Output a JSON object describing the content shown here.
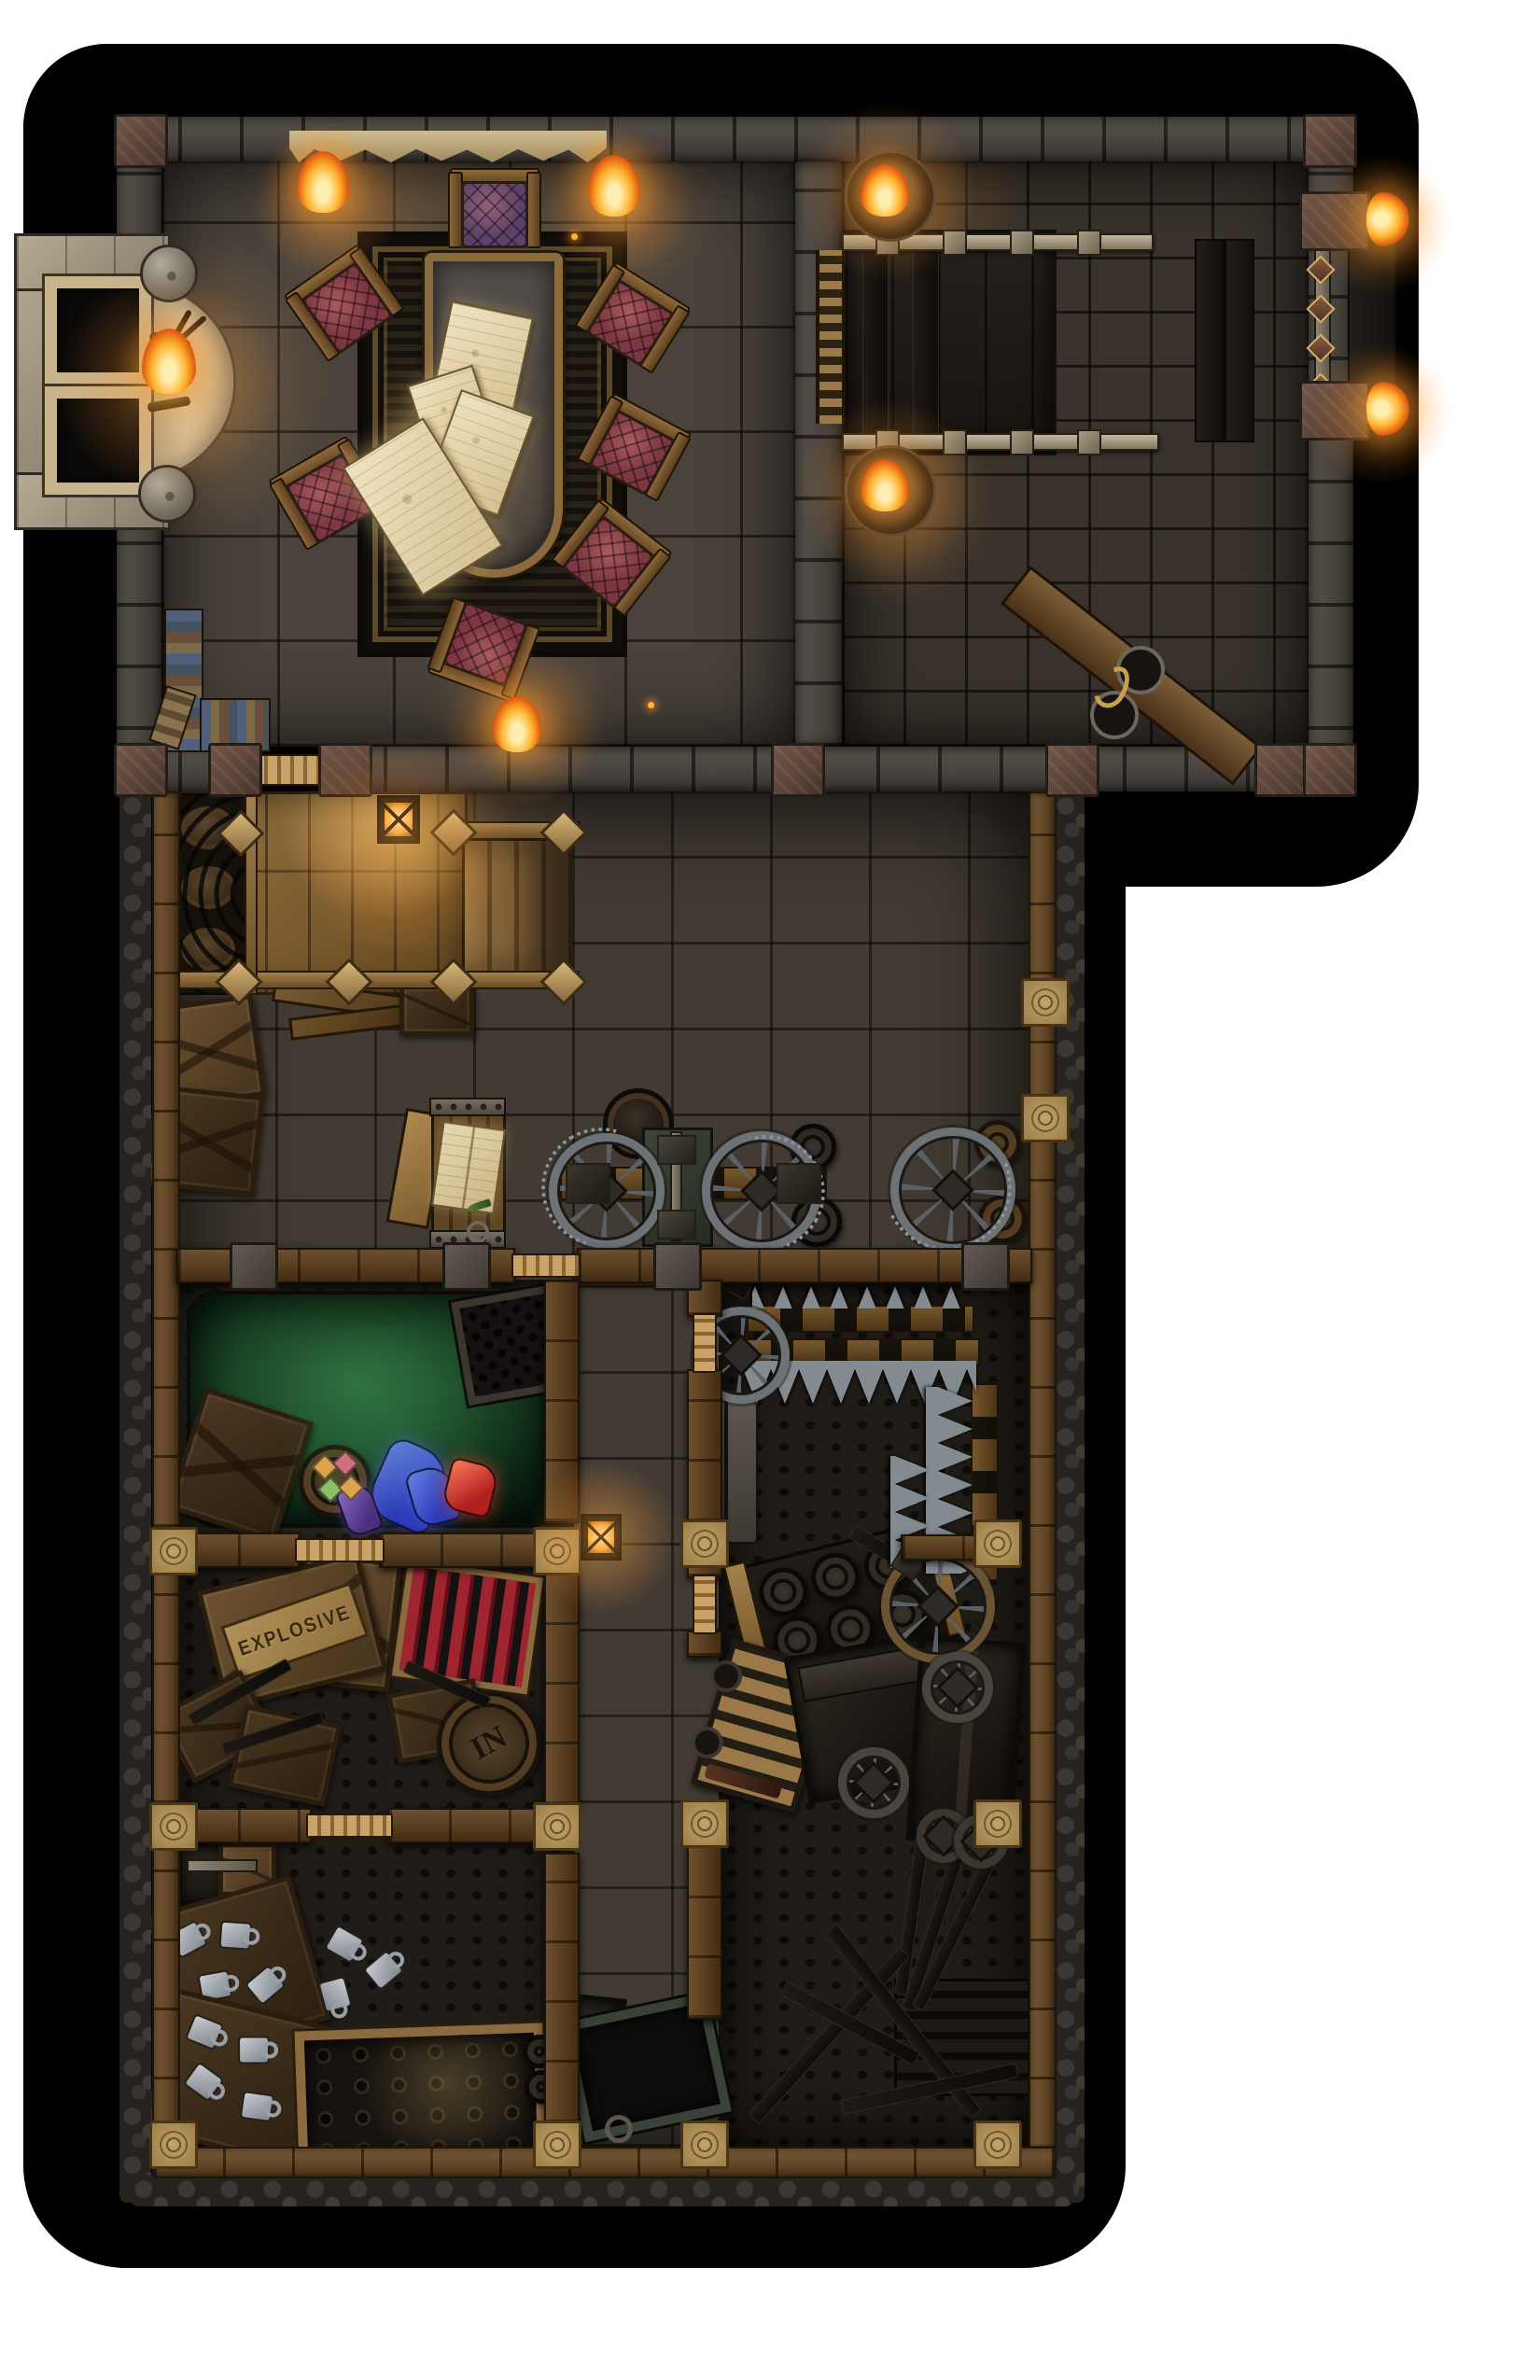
{
  "labels": {
    "explosive_crate": "EXPLOSIVE",
    "barrel_marking": "IN"
  },
  "colors": {
    "page_bg": "#ffffff",
    "canvas": "#000000",
    "wall_stone": "#524c46",
    "wood_beam": "#7b5c36",
    "floor_hall": "#4a433c",
    "floor_cobble": "#39332c",
    "floor_room_dark": "#201c18",
    "rug_base": "#16120e",
    "rug_gold": "#9b7c45",
    "parchment": "#eadcb4",
    "parchment_dark": "#cdb98a",
    "cushion_red": "#7c3742",
    "cushion_purple": "#5c4168",
    "flame_core": "#ffeeb0",
    "flame_mid": "#ffb42e",
    "flame_outer": "#e05c12",
    "pool_green": "#2e6b3c",
    "pool_green_dark": "#0c2414",
    "crate_wood": "#6e5130",
    "crate_wood_dark": "#46341d",
    "rod_red": "#9e2430",
    "steel": "#838a90",
    "crystal_blue": "#4157d8",
    "crystal_red": "#d03a34",
    "gem_orange": "#e8a34c",
    "gem_pink": "#e06a84",
    "gem_green": "#8fc06a",
    "mug_metal": "#a7adb3",
    "lantern_glow": "#ffcf7e"
  }
}
